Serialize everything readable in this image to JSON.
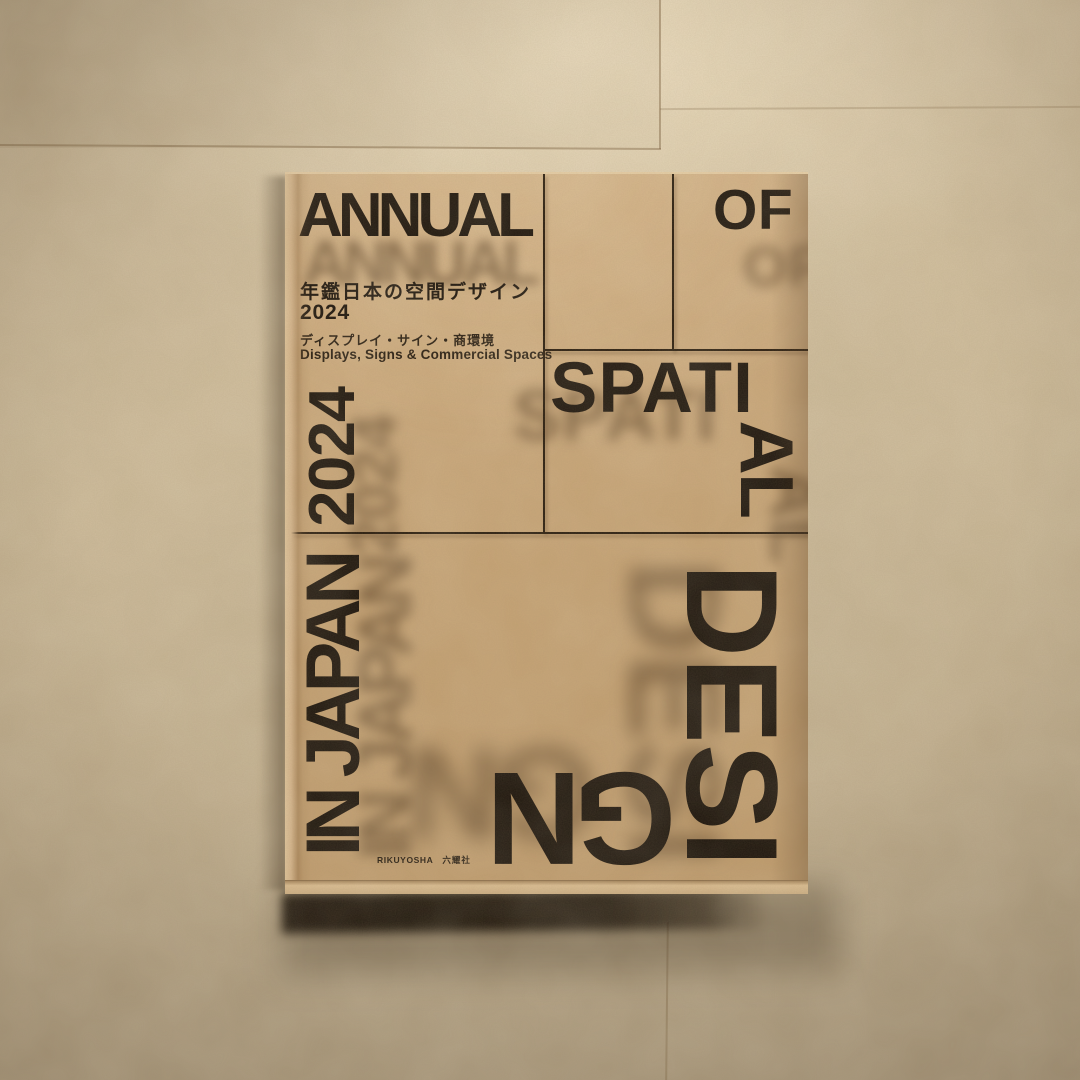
{
  "photo": {
    "subject": "Book lying on a beige stone-tile floor"
  },
  "book": {
    "cover_words": {
      "annual": "ANNUAL",
      "of": "OF",
      "spati": "SPATI",
      "al": "AL",
      "in_japan": "IN JAPAN",
      "desi": "DESI",
      "gn": "GN",
      "year_vertical": "2024"
    },
    "title_block": {
      "title_jp": "年鑑日本の空間デザイン",
      "year": "2024",
      "subtitle_jp": "ディスプレイ・サイン・商環境",
      "subtitle_en": "Displays, Signs & Commercial Spaces"
    },
    "publisher": {
      "name_en": "RIKUYOSHA",
      "name_jp": "六耀社"
    }
  },
  "colors": {
    "ink": "#1b130b",
    "ghost": "rgba(88,64,36,0.6)",
    "rule": "#241709",
    "cover_a": "#cdab7f",
    "cover_b": "#bd9a6c",
    "floor_a": "#d5c3a3",
    "floor_b": "#b5a487",
    "grout": "rgba(115,88,55,0.45)"
  }
}
